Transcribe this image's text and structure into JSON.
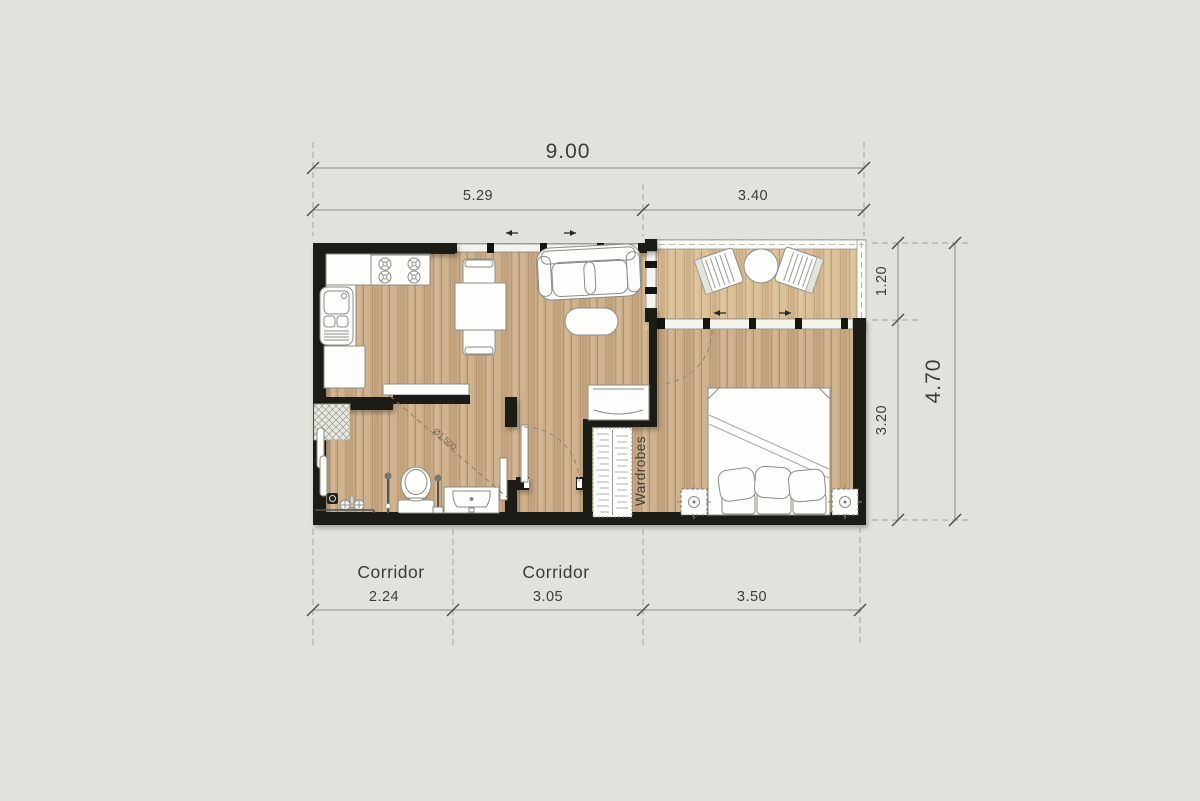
{
  "colors": {
    "background": "#e1e2db",
    "wall": "#1b1b18",
    "floor-wood": "#c9aa87",
    "floor-balcony": "#d6bb93",
    "furniture-fill": "#fdfdfc",
    "furniture-stroke": "#8d8d85",
    "dim-line": "#8b8b83",
    "dim-text": "#3d3d38",
    "annotation": "#75644f"
  },
  "dimensions": {
    "top": {
      "total": "9.00",
      "segments": [
        "5.29",
        "3.40"
      ]
    },
    "right": {
      "total": "4.70",
      "segments": [
        "1.20",
        "3.20"
      ]
    },
    "bottom": {
      "segments": [
        "2.24",
        "3.05",
        "3.50"
      ]
    }
  },
  "labels": {
    "corridor_left": "Corridor",
    "corridor_right": "Corridor",
    "wardrobes": "Wardrobes",
    "turning_circle": "Ø1.500"
  }
}
